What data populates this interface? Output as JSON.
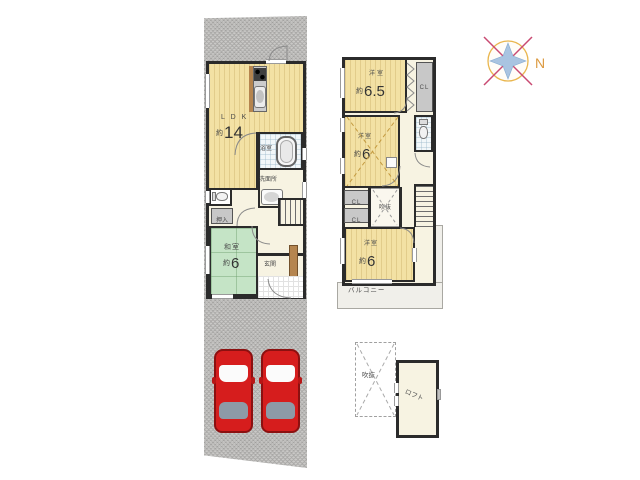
{
  "compass": {
    "north_label": "N"
  },
  "floor1": {
    "ldk": {
      "name": "L D K",
      "approx": "約",
      "area": "14"
    },
    "bath": {
      "name": "浴室"
    },
    "washroom": {
      "name": "洗面所"
    },
    "oshiire": {
      "name": "押入"
    },
    "washitsu": {
      "name": "和室",
      "approx": "約",
      "area": "6"
    },
    "genkan": {
      "name": "玄関"
    }
  },
  "floor2": {
    "bedroom1": {
      "name": "洋室",
      "approx": "約",
      "area": "6.5"
    },
    "closet_top": {
      "name": "CL"
    },
    "bedroom2": {
      "name": "洋室",
      "approx": "約",
      "area": "6"
    },
    "closet_a": {
      "name": "CL"
    },
    "closet_b": {
      "name": "CL"
    },
    "void": {
      "name": "吹抜"
    },
    "bedroom3": {
      "name": "洋室",
      "approx": "約",
      "area": "6"
    },
    "balcony": {
      "name": "バルコニー"
    }
  },
  "loft": {
    "void": {
      "name": "吹抜"
    },
    "room": {
      "name": "ロフト"
    }
  },
  "colors": {
    "room_tan": "#f3e1a4",
    "tatami_green": "#c5e4c6",
    "plot_gray": "#c1c0be",
    "wall": "#2b2b2b",
    "car_red": "#d61d1d",
    "closet_gray": "#c8c8c8",
    "compass_ring": "#e9b64e",
    "compass_star": "#a9c4e1",
    "compass_cross": "#c94a72"
  }
}
